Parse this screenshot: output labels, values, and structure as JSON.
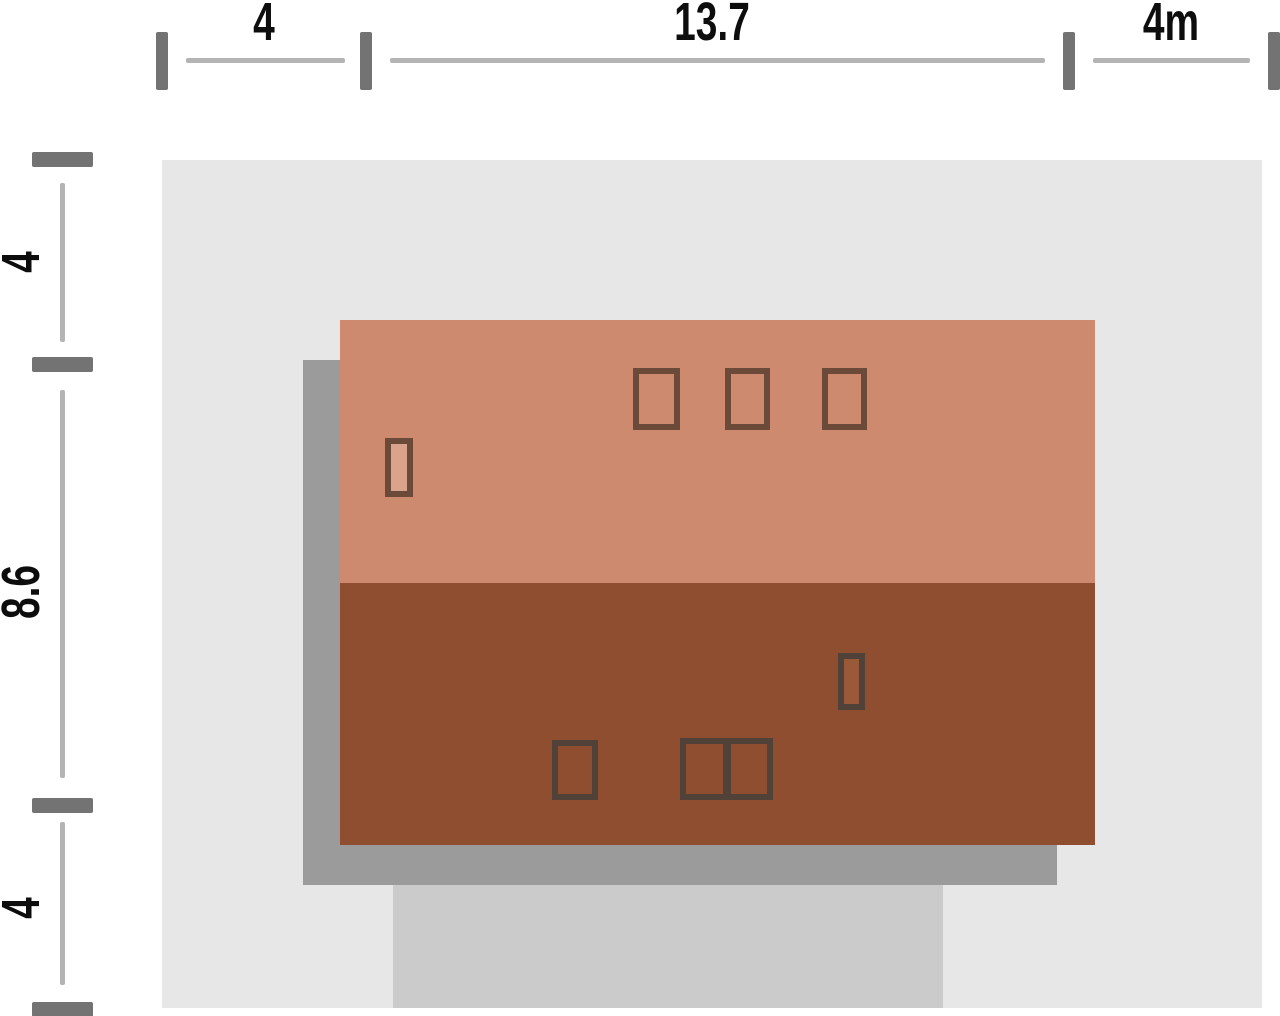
{
  "title": "house-plot-site-plan",
  "colors": {
    "background": "#ffffff",
    "plot": "#e7e7e7",
    "driveway": "#cbcbcb",
    "shadow": "#9b9b9b",
    "roof_upper": "#cd8a6e",
    "roof_lower": "#8f4e30",
    "frame_upper": "#6b4a39",
    "frame_lower": "#504239",
    "chimney_upper": "#d9a48b",
    "chimney_lower": "#9a5a3a",
    "tick": "#737373",
    "dim_line": "#b4b4b4",
    "label_text": "#0d0d0d"
  },
  "dimensions": {
    "top": {
      "segments": [
        {
          "label": "4"
        },
        {
          "label": "13.7"
        },
        {
          "label": "4m"
        }
      ]
    },
    "left": {
      "segments": [
        {
          "label": "4"
        },
        {
          "label": "8.6"
        },
        {
          "label": "4"
        }
      ]
    }
  }
}
